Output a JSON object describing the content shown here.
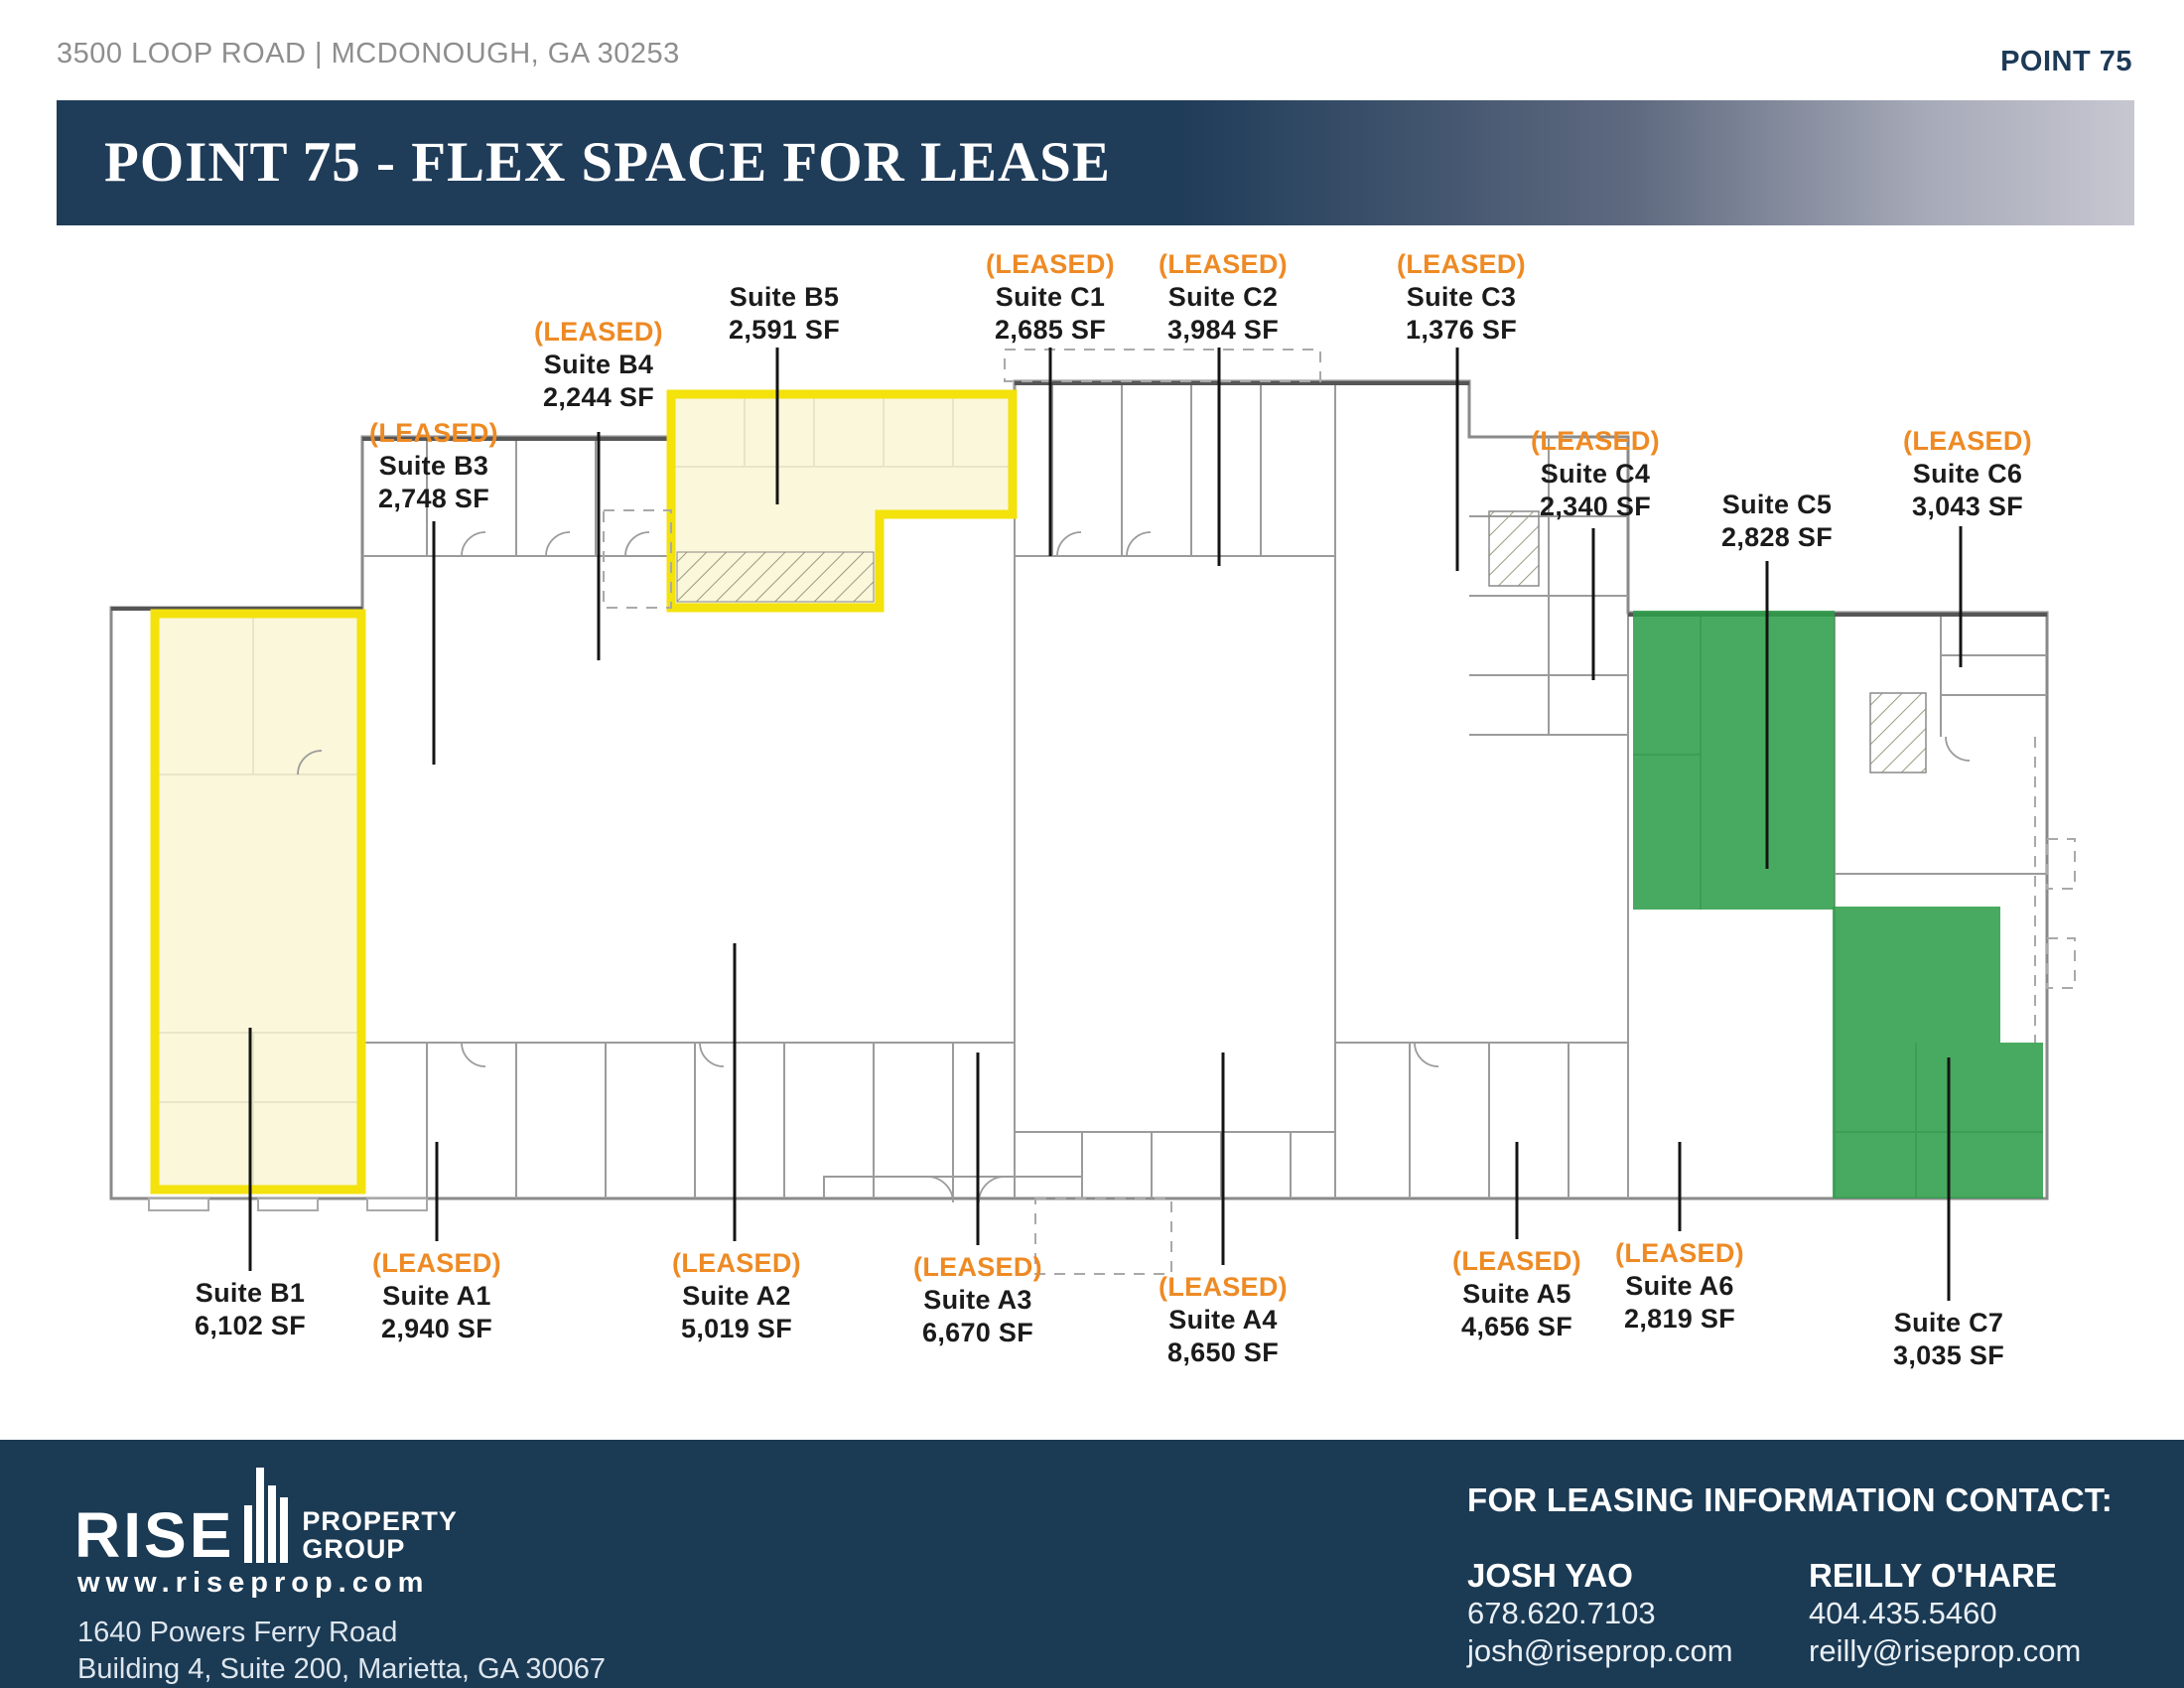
{
  "header": {
    "address": "3500 LOOP ROAD | MCDONOUGH, GA 30253",
    "brand": "POINT 75"
  },
  "banner": {
    "title": "POINT 75 - FLEX SPACE FOR LEASE"
  },
  "plan": {
    "leased_tag": "(LEASED)",
    "legend": {
      "yellow_highlight": "available - outlined yellow",
      "green_highlight": "available - filled green"
    },
    "suites": [
      {
        "id": "B5",
        "name": "Suite B5",
        "sf": "2,591 SF",
        "leased": false,
        "highlight": "yellow"
      },
      {
        "id": "C1",
        "name": "Suite C1",
        "sf": "2,685 SF",
        "leased": true,
        "highlight": null
      },
      {
        "id": "C2",
        "name": "Suite C2",
        "sf": "3,984 SF",
        "leased": true,
        "highlight": null
      },
      {
        "id": "C3",
        "name": "Suite C3",
        "sf": "1,376 SF",
        "leased": true,
        "highlight": null
      },
      {
        "id": "B4",
        "name": "Suite B4",
        "sf": "2,244 SF",
        "leased": true,
        "highlight": null
      },
      {
        "id": "B3",
        "name": "Suite B3",
        "sf": "2,748 SF",
        "leased": true,
        "highlight": null
      },
      {
        "id": "C4",
        "name": "Suite C4",
        "sf": "2,340 SF",
        "leased": true,
        "highlight": null
      },
      {
        "id": "C5",
        "name": "Suite C5",
        "sf": "2,828 SF",
        "leased": false,
        "highlight": "green"
      },
      {
        "id": "C6",
        "name": "Suite C6",
        "sf": "3,043 SF",
        "leased": true,
        "highlight": null
      },
      {
        "id": "B1",
        "name": "Suite B1",
        "sf": "6,102 SF",
        "leased": false,
        "highlight": "yellow"
      },
      {
        "id": "A1",
        "name": "Suite A1",
        "sf": "2,940 SF",
        "leased": true,
        "highlight": null
      },
      {
        "id": "A2",
        "name": "Suite A2",
        "sf": "5,019 SF",
        "leased": true,
        "highlight": null
      },
      {
        "id": "A3",
        "name": "Suite A3",
        "sf": "6,670 SF",
        "leased": true,
        "highlight": null
      },
      {
        "id": "A4",
        "name": "Suite A4",
        "sf": "8,650 SF",
        "leased": true,
        "highlight": null
      },
      {
        "id": "A5",
        "name": "Suite A5",
        "sf": "4,656 SF",
        "leased": true,
        "highlight": null
      },
      {
        "id": "A6",
        "name": "Suite A6",
        "sf": "2,819 SF",
        "leased": true,
        "highlight": null
      },
      {
        "id": "C7",
        "name": "Suite C7",
        "sf": "3,035 SF",
        "leased": false,
        "highlight": "green"
      }
    ]
  },
  "footer": {
    "logo": {
      "brand": "RISE",
      "sub1": "PROPERTY",
      "sub2": "GROUP"
    },
    "website": "www.riseprop.com",
    "address_line1": "1640 Powers Ferry Road",
    "address_line2": "Building 4, Suite 200, Marietta, GA 30067",
    "contact_heading": "FOR LEASING INFORMATION CONTACT:",
    "contacts": [
      {
        "name": "JOSH YAO",
        "phone": "678.620.7103",
        "email": "josh@riseprop.com"
      },
      {
        "name": "REILLY O'HARE",
        "phone": "404.435.5460",
        "email": "reilly@riseprop.com"
      }
    ]
  },
  "colors": {
    "navy": "#1f3c59",
    "leased_orange": "#ee8a24",
    "highlight_yellow": "#f3e20c",
    "highlight_yellow_fill": "#f9f5d2",
    "highlight_green": "#2f9e4a"
  }
}
